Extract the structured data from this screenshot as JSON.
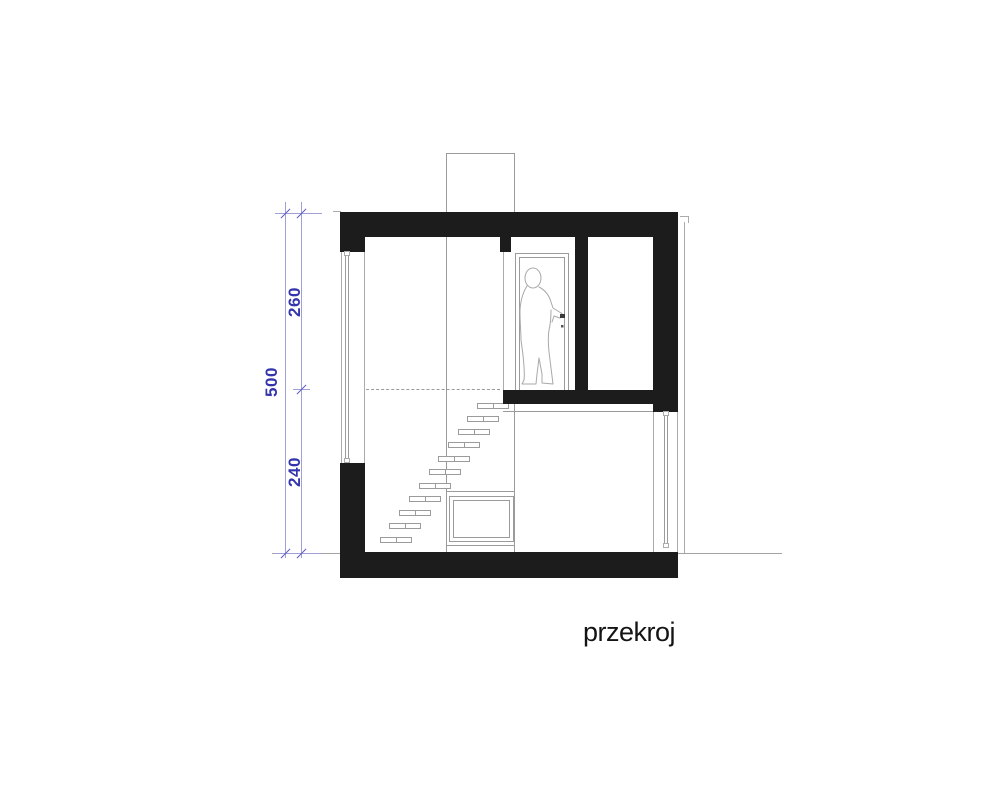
{
  "drawing": {
    "title": "przekroj",
    "dims": {
      "upper": "260",
      "total": "500",
      "lower": "240"
    },
    "colors": {
      "background": "#ffffff",
      "wall": "#1c1c1c",
      "line": "#9b9b9b",
      "line_light": "#ababab",
      "ground": "#a3a3a3",
      "dim_line": "#a0a0d8",
      "dim_tick": "#5f5fc0",
      "dim_text": "#3434ac",
      "title_text": "#141414"
    }
  }
}
